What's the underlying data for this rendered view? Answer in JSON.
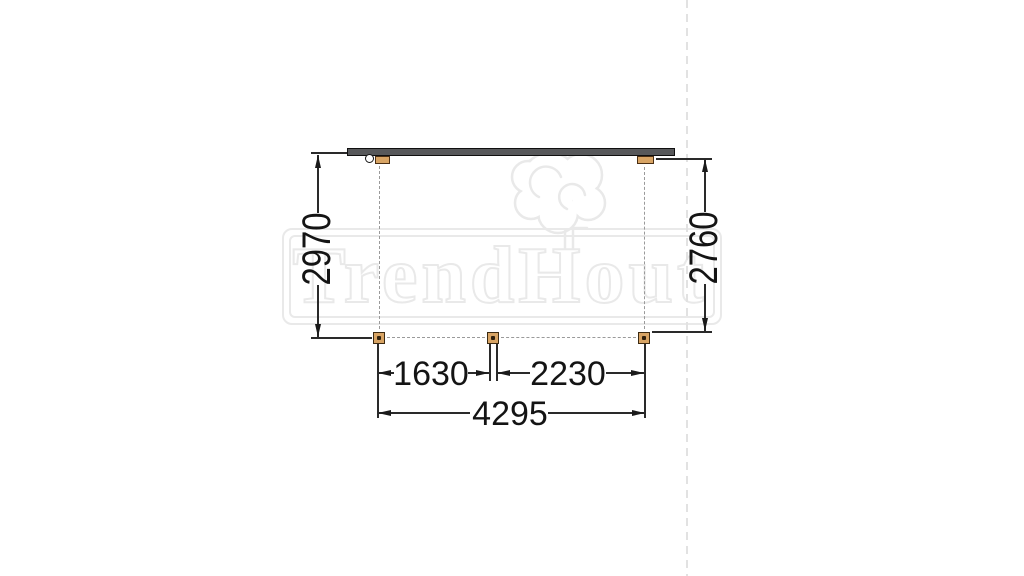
{
  "watermark": {
    "text": "TrendHout",
    "logo": "tree-logo"
  },
  "drawing": {
    "view": "plan-top-view",
    "dimensions": {
      "depth_left": "2970",
      "depth_right": "2760",
      "bay_left": "1630",
      "bay_right": "2230",
      "width_total": "4295"
    },
    "colors": {
      "post_fill": "#d8a464",
      "post_outline": "#4a2f14",
      "beam_fill": "#57585a",
      "dimension_line": "#1a1a1a",
      "dashed_reference": "#9a9a9a",
      "watermark": "#e9e9e9"
    }
  }
}
